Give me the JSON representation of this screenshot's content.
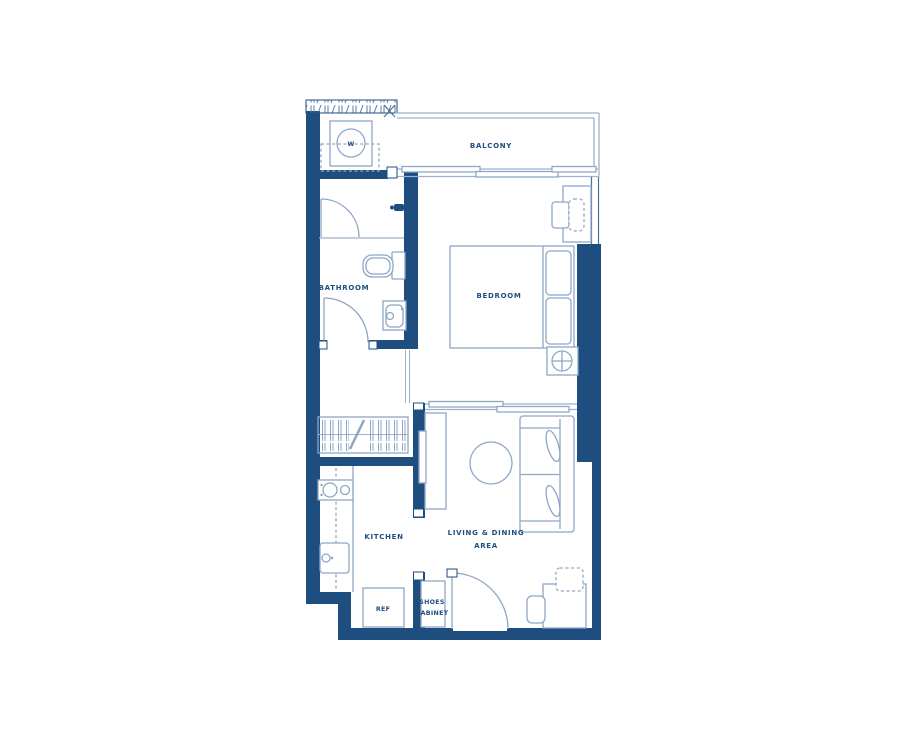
{
  "plan": {
    "rooms": {
      "balcony": {
        "label": "BALCONY"
      },
      "bathroom": {
        "label": "BATHROOM"
      },
      "bedroom": {
        "label": "BEDROOM"
      },
      "kitchen": {
        "label": "KITCHEN"
      },
      "living": {
        "label_line1": "LIVING & DINING",
        "label_line2": "AREA"
      }
    },
    "fixtures": {
      "washer": {
        "label": "W"
      },
      "refrigerator": {
        "label": "REF"
      },
      "shoes_cabinet": {
        "label_line1": "SHOES",
        "label_line2": "CABINET"
      }
    },
    "colors": {
      "wall": "#1e4d7f",
      "structure_line": "#9db0cc",
      "fixture_line": "#8ea6c6",
      "text": "#1e4d7f",
      "background": "#ffffff"
    }
  }
}
